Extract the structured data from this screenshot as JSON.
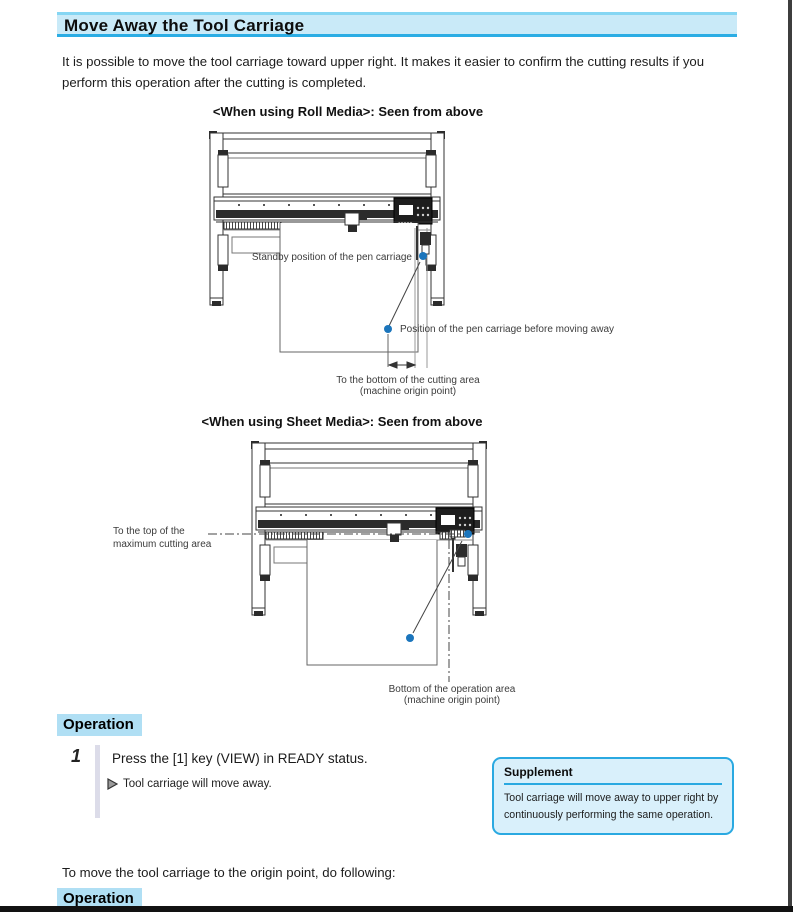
{
  "page": {
    "title": "Move Away the Tool Carriage",
    "intro": "It is possible to move the tool carriage toward upper right. It makes it easier to confirm the cutting results if you perform this operation after the cutting is completed.",
    "accent_color": "#2bade4",
    "highlight_color": "#b0dff4",
    "dot_color": "#1b75bc"
  },
  "diagram_roll": {
    "title": "<When using Roll Media>: Seen from above",
    "labels": {
      "standby": "Standby position of the pen carriage",
      "before_moving": "Position of the pen carriage before moving away",
      "bottom_line1": "To the bottom of the cutting area",
      "bottom_line2": "(machine origin point)"
    }
  },
  "diagram_sheet": {
    "title": "<When using Sheet Media>: Seen from above",
    "labels": {
      "top_line1": "To the top of the",
      "top_line2": "maximum cutting area",
      "bottom_line1": "Bottom of the operation area",
      "bottom_line2": "(machine origin point)"
    }
  },
  "operation1": {
    "heading": "Operation",
    "step_number": "1",
    "step_text": "Press the [1] key (VIEW) in READY status.",
    "result_text": "Tool carriage will move away."
  },
  "supplement": {
    "heading": "Supplement",
    "text": "Tool carriage will move away to upper right by continuously performing the same operation."
  },
  "closing": {
    "text": "To move the tool carriage to the origin point, do following:"
  },
  "operation2": {
    "heading": "Operation"
  }
}
